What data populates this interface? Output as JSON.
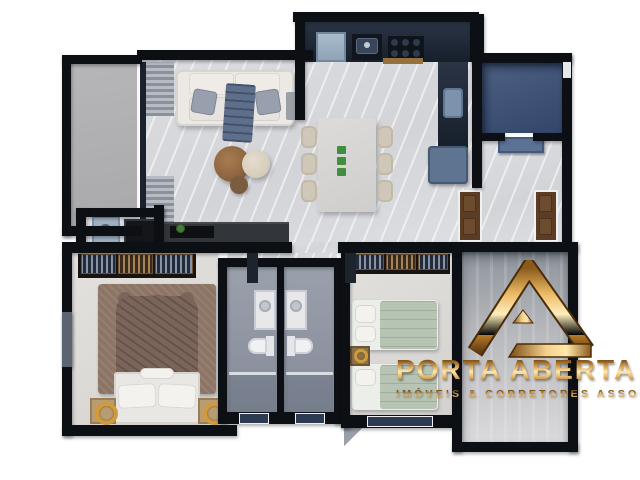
{
  "watermark": {
    "brand": "PORTA ABERTA",
    "tagline": "IMÓVEIS & CORRETORES ASSOCIADOS",
    "logo_icon": "gold-triangle-a-icon",
    "gold_color": "#c9963d"
  },
  "scene": {
    "type": "3d-top-view-floor-plan",
    "rooms": [
      "balcony",
      "living-room",
      "kitchen",
      "dining-area",
      "service-area",
      "corridor",
      "laundry-nook",
      "master-bedroom",
      "bathroom-1",
      "bathroom-2",
      "second-bedroom",
      "side-room"
    ]
  },
  "palette": {
    "background": "#ffffff",
    "walls": "#0c0f13",
    "wall_trim": "#f7f7f7",
    "marble_floor": "#d8d9dd",
    "balcony_floor": "#b1b1b3",
    "service_floor_blue": "#3e5273",
    "bathroom_floor": "#9298a4",
    "stone_floor": "#bfc0c3",
    "kitchen_counter": "#1f2835",
    "cabinet_blue": "#5e7490",
    "door_wood": "#5a3d24",
    "sage_bedding": "#b7c3b3",
    "rug_brown": "#8d7566",
    "gold": "#c9963d",
    "window_glass": "#2c3a52"
  }
}
